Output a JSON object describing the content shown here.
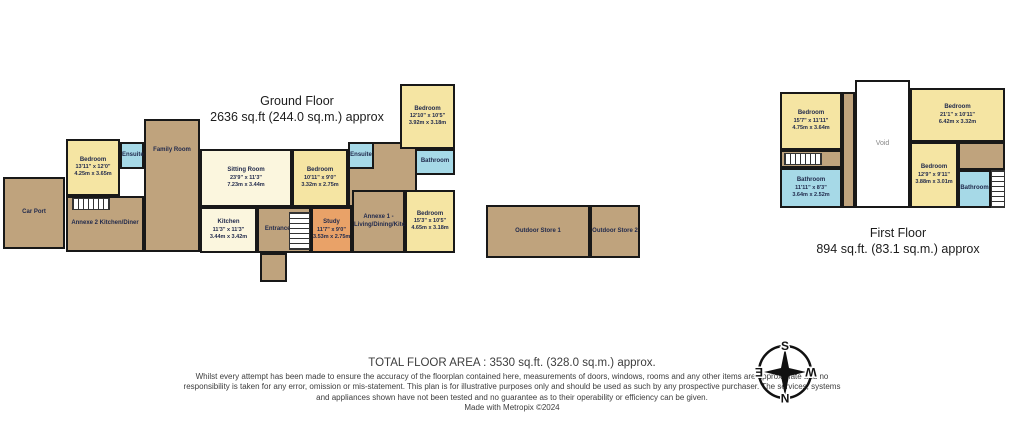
{
  "floors": [
    {
      "title": "Ground Floor",
      "subtitle": "2636 sq.ft (244.0 sq.m.) approx",
      "rooms": [
        {
          "name": "Car Port",
          "x": 3,
          "y": 177,
          "w": 62,
          "h": 72,
          "color": "#bfa37d"
        },
        {
          "name": "Annexe 2 Kitchen/Diner",
          "x": 66,
          "y": 196,
          "w": 78,
          "h": 56,
          "color": "#bfa37d"
        },
        {
          "type": "stairs",
          "dir": "h",
          "x": 72,
          "y": 198,
          "w": 38,
          "h": 12
        },
        {
          "name": "Bedroom",
          "imperial": "13'11\" x 12'0\"",
          "metric": "4.25m x 3.65m",
          "x": 66,
          "y": 139,
          "w": 54,
          "h": 57,
          "color": "#f5e5a3"
        },
        {
          "name": "Ensuite",
          "x": 120,
          "y": 142,
          "w": 24,
          "h": 27,
          "color": "#a6d9e7"
        },
        {
          "name": "Family Room",
          "x": 144,
          "y": 119,
          "w": 56,
          "h": 133,
          "color": "#bfa37d",
          "labelPos": "top"
        },
        {
          "name": "Sitting Room",
          "imperial": "23'9\" x 11'3\"",
          "metric": "7.23m x 3.44m",
          "x": 200,
          "y": 149,
          "w": 92,
          "h": 58,
          "color": "#fbf6de"
        },
        {
          "name": "Kitchen",
          "imperial": "11'3\" x 11'3\"",
          "metric": "3.44m x 3.42m",
          "x": 200,
          "y": 207,
          "w": 57,
          "h": 46,
          "color": "#fbf6de"
        },
        {
          "name": "Entrance Hall",
          "x": 257,
          "y": 207,
          "w": 54,
          "h": 46,
          "color": "#bfa37d"
        },
        {
          "type": "stairs",
          "dir": "v",
          "x": 289,
          "y": 212,
          "w": 21,
          "h": 38
        },
        {
          "name": "",
          "x": 260,
          "y": 253,
          "w": 27,
          "h": 29,
          "color": "#bfa37d"
        },
        {
          "name": "Bedroom",
          "imperial": "10'11\" x 9'0\"",
          "metric": "3.32m x 2.75m",
          "x": 292,
          "y": 149,
          "w": 56,
          "h": 58,
          "color": "#f5e5a3"
        },
        {
          "name": "",
          "x": 348,
          "y": 142,
          "w": 69,
          "h": 65,
          "color": "#bfa37d"
        },
        {
          "name": "Ensuite",
          "x": 348,
          "y": 142,
          "w": 26,
          "h": 27,
          "color": "#a6d9e7"
        },
        {
          "name": "Bathroom",
          "x": 415,
          "y": 149,
          "w": 40,
          "h": 26,
          "color": "#a6d9e7"
        },
        {
          "name": "Bedroom",
          "imperial": "12'10\" x 10'5\"",
          "metric": "3.92m x 3.18m",
          "x": 400,
          "y": 84,
          "w": 55,
          "h": 65,
          "color": "#f5e5a3"
        },
        {
          "name": "Study",
          "imperial": "11'7\" x 9'0\"",
          "metric": "3.53m x 2.75m",
          "x": 311,
          "y": 207,
          "w": 41,
          "h": 46,
          "color": "#e9a268"
        },
        {
          "name": "Annexe 1 -",
          "name2": "Living/Dining/Kitchenette",
          "x": 352,
          "y": 190,
          "w": 53,
          "h": 63,
          "color": "#bfa37d"
        },
        {
          "name": "Bedroom",
          "imperial": "15'3\" x 10'5\"",
          "metric": "4.65m x 3.18m",
          "x": 405,
          "y": 190,
          "w": 50,
          "h": 63,
          "color": "#f5e5a3"
        },
        {
          "name": "Outdoor Store 1",
          "x": 486,
          "y": 205,
          "w": 104,
          "h": 53,
          "color": "#bfa37d"
        },
        {
          "name": "Outdoor Store 2",
          "x": 590,
          "y": 205,
          "w": 50,
          "h": 53,
          "color": "#bfa37d"
        }
      ]
    },
    {
      "title": "First Floor",
      "subtitle": "894 sq.ft. (83.1 sq.m.) approx",
      "rooms": [
        {
          "name": "",
          "x": 842,
          "y": 92,
          "w": 13,
          "h": 116,
          "color": "#bfa37d"
        },
        {
          "name": "Bedroom",
          "imperial": "15'7\" x 11'11\"",
          "metric": "4.75m x 3.64m",
          "x": 780,
          "y": 92,
          "w": 62,
          "h": 58,
          "color": "#f5e5a3"
        },
        {
          "name": "",
          "x": 780,
          "y": 150,
          "w": 62,
          "h": 18,
          "color": "#bfa37d"
        },
        {
          "type": "stairs",
          "dir": "h",
          "x": 784,
          "y": 153,
          "w": 38,
          "h": 12
        },
        {
          "name": "Bathroom",
          "imperial": "11'11\" x 8'3\"",
          "metric": "3.64m x 2.52m",
          "x": 780,
          "y": 168,
          "w": 62,
          "h": 40,
          "color": "#a6d9e7"
        },
        {
          "name": "Void",
          "x": 855,
          "y": 80,
          "w": 55,
          "h": 128,
          "color": "#ffffff",
          "void": true
        },
        {
          "name": "Bedroom",
          "imperial": "21'1\" x 10'11\"",
          "metric": "6.42m x 3.32m",
          "x": 910,
          "y": 88,
          "w": 95,
          "h": 54,
          "color": "#f5e5a3"
        },
        {
          "name": "Bedroom",
          "imperial": "12'9\" x 9'11\"",
          "metric": "3.88m x 3.01m",
          "x": 910,
          "y": 142,
          "w": 48,
          "h": 66,
          "color": "#f5e5a3"
        },
        {
          "name": "",
          "x": 958,
          "y": 142,
          "w": 47,
          "h": 28,
          "color": "#bfa37d"
        },
        {
          "name": "Bathroom",
          "x": 958,
          "y": 170,
          "w": 33,
          "h": 38,
          "color": "#a6d9e7"
        },
        {
          "type": "stairs",
          "dir": "v",
          "x": 991,
          "y": 170,
          "w": 14,
          "h": 38
        }
      ]
    }
  ],
  "footer": {
    "total": "TOTAL FLOOR AREA : 3530 sq.ft. (328.0 sq.m.) approx.",
    "disclaimer": "Whilst every attempt has been made to ensure the accuracy of the floorplan contained here, measurements of doors, windows, rooms and any other items are approximate and no responsibility is taken for any error, omission or mis-statement. This plan is for illustrative purposes only and should be used as such by any prospective purchaser. The services, systems and appliances shown have not been tested and no guarantee as to their operability or efficiency can be given.",
    "credit": "Made with Metropix ©2024"
  },
  "compass": {
    "top": "S",
    "bottom": "N",
    "left": "E",
    "right": "W"
  },
  "colors": {
    "walls": "#181818",
    "room_text": "#222b4d",
    "bedroom": "#f5e5a3",
    "bathroom": "#a6d9e7",
    "living": "#fbf6de",
    "hall": "#bfa37d",
    "study": "#e9a268"
  }
}
